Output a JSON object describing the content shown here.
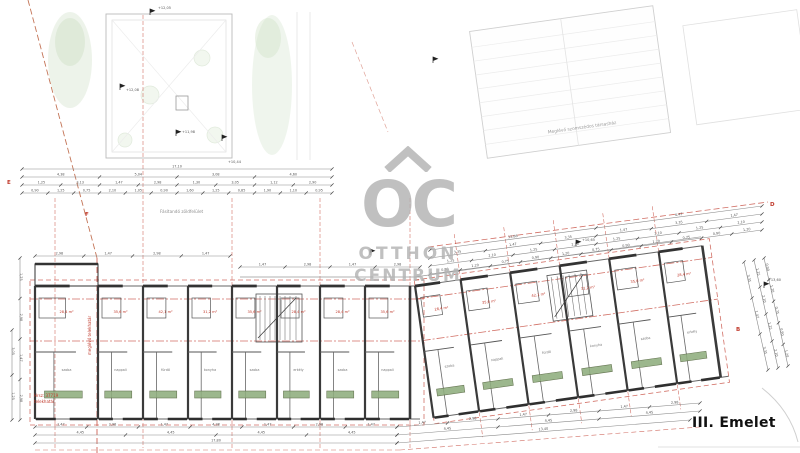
{
  "floor_label": "III. Emelet",
  "watermark": {
    "monogram": "OC",
    "name_line1": "OTTHON",
    "name_line2": "CENTRUM"
  },
  "annotations": {
    "neighbor_building": "Meglévő szomszédos társasház",
    "green_area": "Fásítandó zöldfelület",
    "plot_number": "Hrsz: 37719",
    "plot_sub": "telekhatár",
    "boundary_line": "meglévő telekhatár"
  },
  "section_markers": {
    "d": "D",
    "b": "B",
    "e": "E",
    "f": "F"
  },
  "elevations": [
    "+12,05",
    "+12,08",
    "+11,98",
    "+10,44",
    "+13,60",
    "+10,65"
  ],
  "dimensions": {
    "chains": [
      [
        "17,10"
      ],
      [
        "4,38",
        "5,04",
        "3,08",
        "4,60"
      ],
      [
        "1,25",
        "3,13",
        "1,47",
        "2,98",
        "1,30",
        "3,05",
        "1,12",
        "2,90"
      ],
      [
        "0,90",
        "1,25",
        "0,75",
        "2,10",
        "1,05",
        "0,90",
        "1,60",
        "1,25",
        "0,85",
        "1,90",
        "1,10",
        "0,95"
      ],
      [
        "12,88",
        "6,47"
      ],
      [
        "3,35",
        "1,47",
        "3,35",
        "1,47",
        "3,35",
        "1,47"
      ],
      [
        "1,25",
        "2,10",
        "1,25",
        "2,10",
        "1,25",
        "2,10",
        "1,25",
        "2,10"
      ],
      [
        "0,90",
        "1,20",
        "0,75",
        "0,90",
        "1,20",
        "0,75",
        "0,90",
        "1,20",
        "0,75",
        "0,90",
        "1,20"
      ],
      [
        "3,35",
        "1,47",
        "3,35"
      ],
      [
        "1,25",
        "2,10",
        "1,25",
        "2,10"
      ],
      [
        "0,90",
        "1,20",
        "0,75",
        "0,90",
        "1,20"
      ],
      [
        "1,47",
        "2,98",
        "1,47",
        "4,38",
        "1,47",
        "2,98",
        "1,47"
      ],
      [
        "4,45",
        "4,45",
        "4,45",
        "4,45"
      ],
      [
        "17,80"
      ],
      [
        "1,47",
        "2,98",
        "1,47",
        "2,98",
        "1,47",
        "2,98"
      ],
      [
        "4,45",
        "4,45",
        "4,45"
      ],
      [
        "13,40"
      ],
      [
        "1,25",
        "2,98",
        "1,47",
        "2,98"
      ],
      [
        "3,05",
        "1,25"
      ],
      [
        "2,98",
        "1,47",
        "2,98",
        "1,47"
      ],
      [
        "1,47",
        "2,98",
        "1,47",
        "2,98"
      ]
    ]
  },
  "units": {
    "area_labels": [
      "28,4 m²",
      "35,6 m²",
      "42,1 m²",
      "31,2 m²",
      "35,6 m²",
      "28,4 m²"
    ],
    "room_labels": [
      "szoba",
      "nappali",
      "fürdő",
      "konyha",
      "szoba",
      "erkély"
    ]
  },
  "colors": {
    "dim_red": "#c0392b",
    "wall": "#3a3a3a",
    "balcony_green": "#8fae7e",
    "watermark_gray": "#b3b3b3"
  }
}
